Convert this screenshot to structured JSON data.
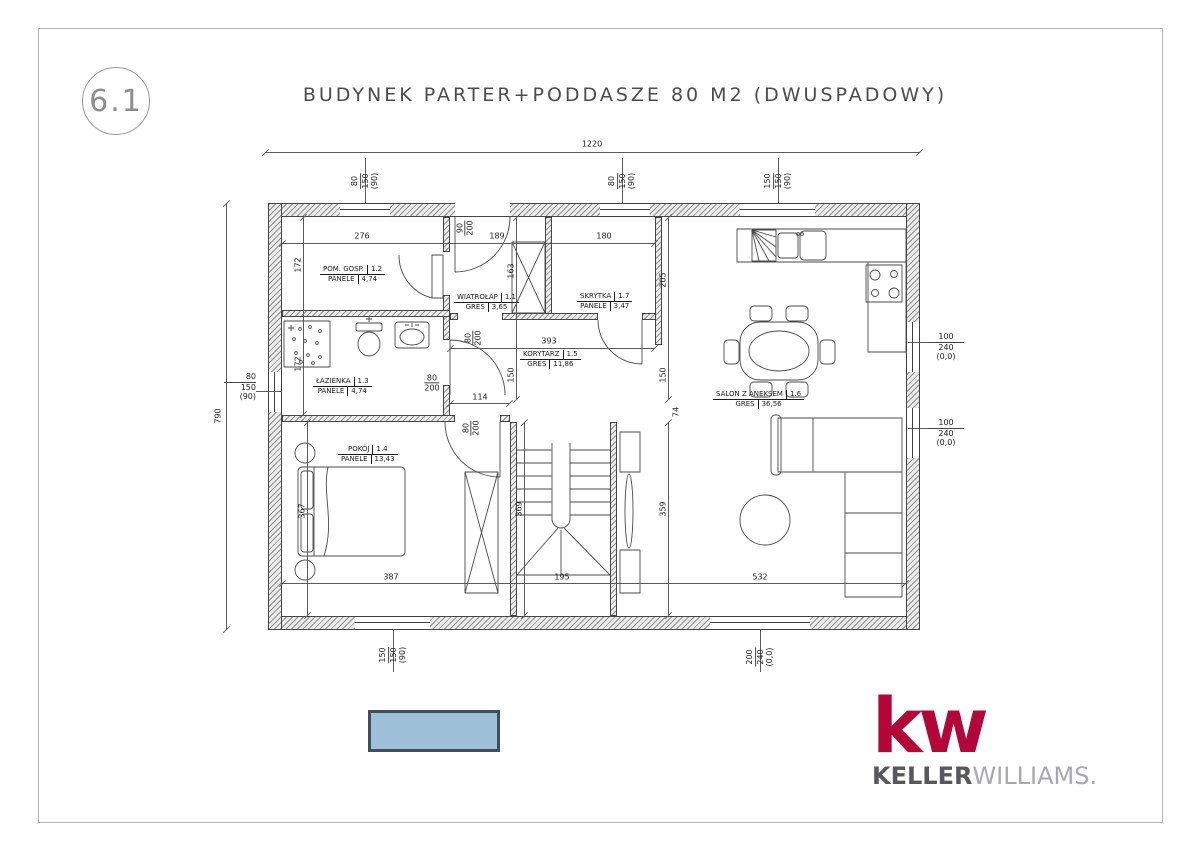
{
  "sheet": {
    "number": "6.1"
  },
  "title": "BUDYNEK PARTER+PODDASZE 80 M2 (DWUSPADOWY)",
  "rooms": [
    {
      "name": "WIATROŁAP",
      "number": "1.1",
      "floor": "GRES",
      "area": "3,65"
    },
    {
      "name": "POM. GOSP.",
      "number": "1.2",
      "floor": "PANELE",
      "area": "4,74"
    },
    {
      "name": "ŁAZIENKA",
      "number": "1.3",
      "floor": "PANELE",
      "area": "4,74"
    },
    {
      "name": "POKÓJ",
      "number": "1.4",
      "floor": "PANELE",
      "area": "13,43"
    },
    {
      "name": "KORYTARZ",
      "number": "1.5",
      "floor": "GRES",
      "area": "11,86"
    },
    {
      "name": "SALON Z ANEKSEM",
      "number": "1.6",
      "floor": "GRES",
      "area": "36,56"
    },
    {
      "name": "SKRYTKA",
      "number": "1.7",
      "floor": "PANELE",
      "area": "3,47"
    }
  ],
  "dims": [
    "1220",
    "790",
    "276",
    "172",
    "172",
    "189",
    "163",
    "180",
    "205",
    "393",
    "150",
    "150",
    "114",
    "387",
    "195",
    "532",
    "367",
    "369",
    "359",
    "74"
  ],
  "door_tags": [
    {
      "w": "90",
      "h": "200"
    },
    {
      "w": "80",
      "h": "200"
    },
    {
      "w": "80",
      "h": "200"
    },
    {
      "w": "80",
      "h": "200"
    }
  ],
  "window_tags": [
    {
      "w": "80",
      "h": "150",
      "sill": "(90)"
    },
    {
      "w": "80",
      "h": "150",
      "sill": "(90)"
    },
    {
      "w": "150",
      "h": "150",
      "sill": "(90)"
    },
    {
      "w": "80",
      "h": "150",
      "sill": "(90)"
    },
    {
      "w": "100",
      "h": "240",
      "sill": "(0,0)"
    },
    {
      "w": "100",
      "h": "240",
      "sill": "(0,0)"
    },
    {
      "w": "150",
      "h": "150",
      "sill": "(90)"
    },
    {
      "w": "200",
      "h": "240",
      "sill": "(0,0)"
    }
  ],
  "legend": {
    "swatch_color": "#9DBFD8",
    "swatch_border": "#3F4F5E"
  },
  "logo": {
    "mark": "kw",
    "name_bold": "KELLER",
    "name_light": "WILLIAMS",
    "suffix": ".",
    "red": "#B20738",
    "gray_dark": "#57585B",
    "gray_light": "#A7A9AC"
  }
}
